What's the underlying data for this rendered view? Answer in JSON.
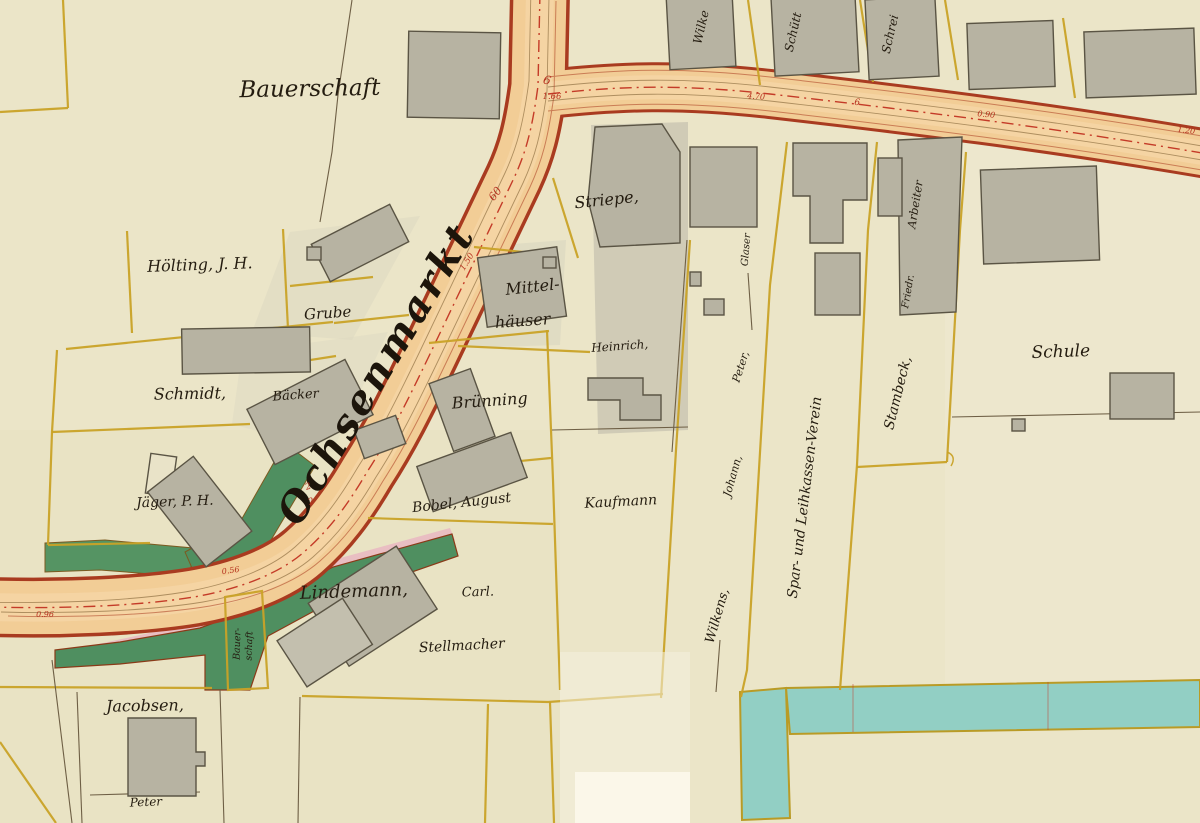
{
  "map": {
    "street": {
      "name": "Ochsenmarkt"
    },
    "labels": {
      "bauerschaft": "Bauerschaft",
      "hoelting": "Hölting, J. H.",
      "grube": "Grube",
      "schmidt": "Schmidt,",
      "baecker": "Bäcker",
      "striepe": "Striepe,",
      "mittel_line1": "Mittel-",
      "mittel_line2": "häuser",
      "heinrich": "Heinrich,",
      "bruenning": "Brünning",
      "bobel": "Bobel,  August",
      "kaufmann": "Kaufmann",
      "jaeger": "Jäger, P. H.",
      "lindemann": "Lindemann,",
      "lindemann_first": "Carl.",
      "stellmacher": "Stellmacher",
      "jacobsen": "Jacobsen,",
      "peter_bottom": "Peter",
      "bauer_small_1": "Bauer-",
      "bauer_small_2": "schaft",
      "wilkens": "Wilkens,",
      "wilkens_first": "Johann,",
      "wilkens_middle": "Peter,",
      "spar_verein": "Spar- und Leihkassen-Verein",
      "stambeck": "Stambeck,",
      "stambeck_first": "Friedr.",
      "glaser": "Glaser",
      "arbeiter": "Arbeiter",
      "schule": "Schule",
      "top_edge_1": "Wilke",
      "top_edge_2": "Schütt",
      "top_edge_3": "Schrei"
    },
    "measurements": {
      "junction_mark": "6",
      "m166": "1.66",
      "m60": "60",
      "m150": "1.50",
      "m2a": "2",
      "m2b": "2",
      "m056": "0.56",
      "m096": "0.96",
      "m470": "4.70",
      "m6": "6",
      "m090": "0.90",
      "m120": "1.20"
    },
    "colors": {
      "paper": "#ebe5c8",
      "road_fill": "#f2cd96",
      "road_edge": "#a93b20",
      "parcel_line": "#c9a227",
      "building": "#b7b3a2",
      "building_outline": "#5a5444",
      "green_strip": "#4f8f60",
      "pink_strip": "#e9b9c2",
      "water": "#92cfc4",
      "ink": "#241c10",
      "measure_red": "#b5321f"
    }
  }
}
